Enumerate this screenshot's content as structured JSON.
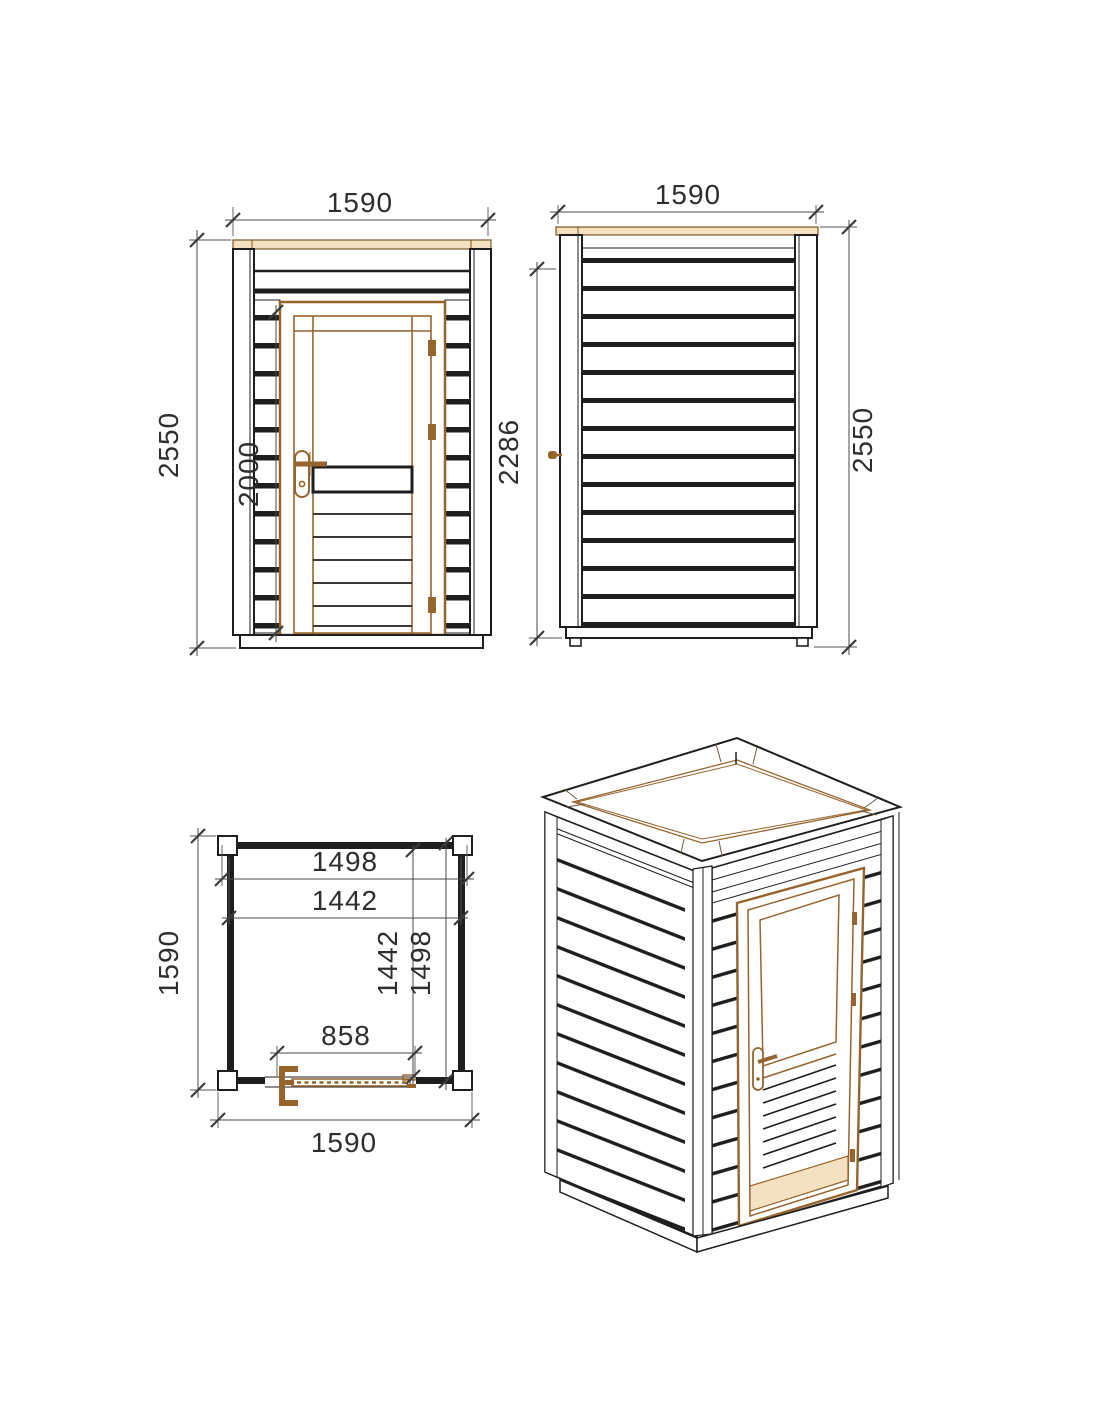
{
  "colors": {
    "line": "#1e1e1e",
    "dimension_line": "#4a4a4a",
    "wood_brown": "#96642d",
    "wood_tan": "#f3e1c2",
    "background": "#ffffff"
  },
  "front_view": {
    "width": "1590",
    "height": "2550",
    "door_height": "2000"
  },
  "side_view": {
    "width": "1590",
    "wall_height": "2286",
    "height": "2550"
  },
  "plan_view": {
    "roof_width": "1498",
    "inner_width": "1442",
    "inner_depth": "1442",
    "roof_depth": "1498",
    "door_width": "858",
    "side_depth": "1590",
    "width": "1590"
  }
}
